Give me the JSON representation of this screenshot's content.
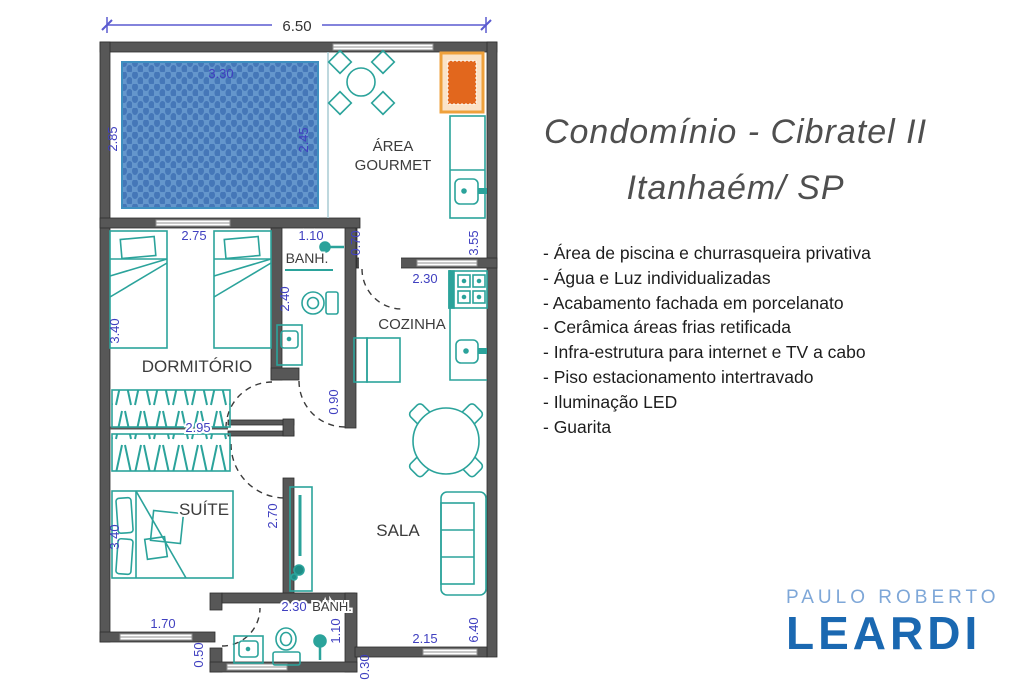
{
  "plan": {
    "rooms": {
      "area_gourmet_line1": "ÁREA",
      "area_gourmet_line2": "GOURMET",
      "banh1": "BANH.",
      "cozinha": "COZINHA",
      "dormitorio": "DORMITÓRIO",
      "suite": "SUÍTE",
      "sala": "SALA",
      "banh2": "BANH."
    },
    "dims": {
      "total_width": "6.50",
      "pool_width": "3.30",
      "pool_height_left": "2.85",
      "pool_height_right": "2.45",
      "dorm_width": "2.75",
      "banh1_width": "1.10",
      "banh1_side": "0.70",
      "gourmet_height": "3.55",
      "dorm_height": "3.40",
      "banh1_height": "2.40",
      "cozinha_door": "2.30",
      "hall_width": "0.90",
      "wardrobe_width": "2.95",
      "suite_side": "2.70",
      "suite_height": "3.40",
      "suite_width": "1.70",
      "banh2_width": "2.30",
      "banh2_height": "1.10",
      "offset_left": "0.50",
      "offset_right": "0.30",
      "sala_width": "2.15",
      "sala_height": "6.40"
    }
  },
  "panel": {
    "title_line1": "Condomínio - Cibratel II",
    "title_line2": "Itanhaém/ SP",
    "features": [
      "- Área de piscina e churrasqueira privativa",
      "- Água e Luz individualizadas",
      "- Acabamento fachada em porcelanato",
      "- Cerâmica áreas frias retificada",
      "- Infra-estrutura para internet e TV a cabo",
      "- Piso estacionamento intertravado",
      "- Iluminação LED",
      "- Guarita"
    ]
  },
  "logo": {
    "top": "PAULO ROBERTO",
    "bottom": "LEARDI"
  },
  "colors": {
    "wall": "#575757",
    "furniture": "#2BA39B",
    "dimension_text": "#4040C0",
    "pool_fill": "#6496CC",
    "pool_dot": "#4577B8",
    "grill_orange": "#E2671D",
    "grill_frame": "#EFA13C",
    "logo_light_blue": "#7EA7D8",
    "logo_dark_blue": "#1A68B1",
    "title_gray": "#4F4F4F"
  }
}
